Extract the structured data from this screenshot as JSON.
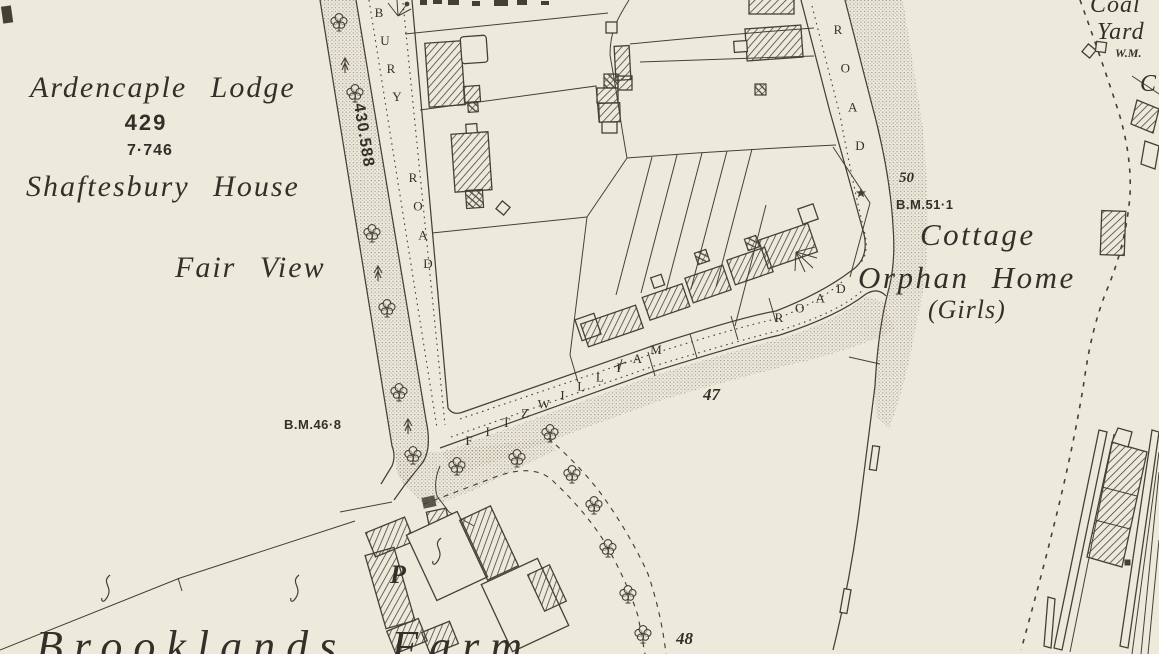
{
  "map": {
    "colors": {
      "paper": "#edeadc",
      "ink": "#454034",
      "shade": "#857e6e",
      "text": "#33302a"
    },
    "place_labels": {
      "ardencaple_lodge": "Ardencaple Lodge",
      "plot_number_429": "429",
      "acreage_7_746": "7·746",
      "shaftesbury_house": "Shaftesbury House",
      "fair_view": "Fair View",
      "benchmark_46_8": "B.M.46·8",
      "road_length_430_588": "430.588",
      "road_number_47": "47",
      "road_number_48": "48",
      "spot_height_50": "50",
      "benchmark_51_1": "B.M.51·1",
      "cottage": "Cottage",
      "orphan_home": "Orphan Home",
      "girls": "(Girls)",
      "coal": "Coal",
      "yard": "Yard",
      "weighing_machine": "W.M.",
      "c_partial": "C",
      "post_office": "P",
      "brooklands_farm": "Brooklands Farm"
    },
    "road_names": {
      "bury_word1": "BURY",
      "bury_word2": "ROAD",
      "east_road": "ROAD",
      "fitzwilliam_word1": "FITZWILLIAM",
      "fitzwilliam_word2": "ROAD"
    }
  }
}
